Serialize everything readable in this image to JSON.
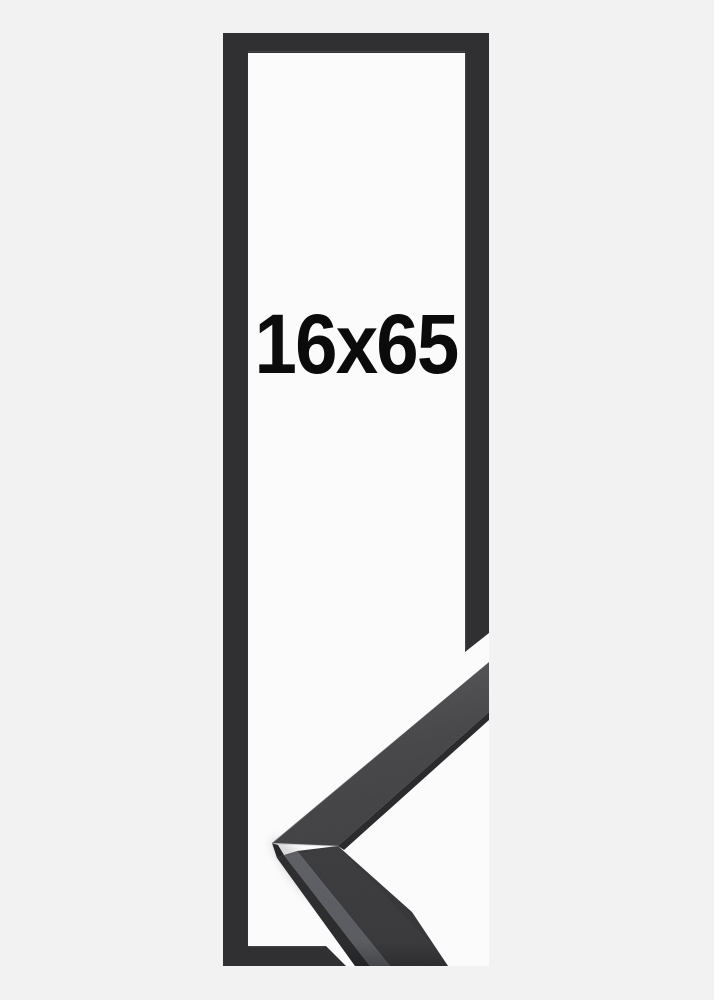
{
  "product": {
    "size_label": "16x65"
  },
  "colors": {
    "background": "#f2f2f3",
    "frame_interior": "#fbfbfb",
    "frame_outline": "#303032",
    "sample_face_upper": "#404043",
    "sample_face_lower": "#3a3a3d",
    "sample_top_edge_gray": "#5d5e63",
    "sample_shadow_edge": "#2b2b2d",
    "sample_corner_facet": "#27272a",
    "label_text": "#0b0b0c"
  }
}
